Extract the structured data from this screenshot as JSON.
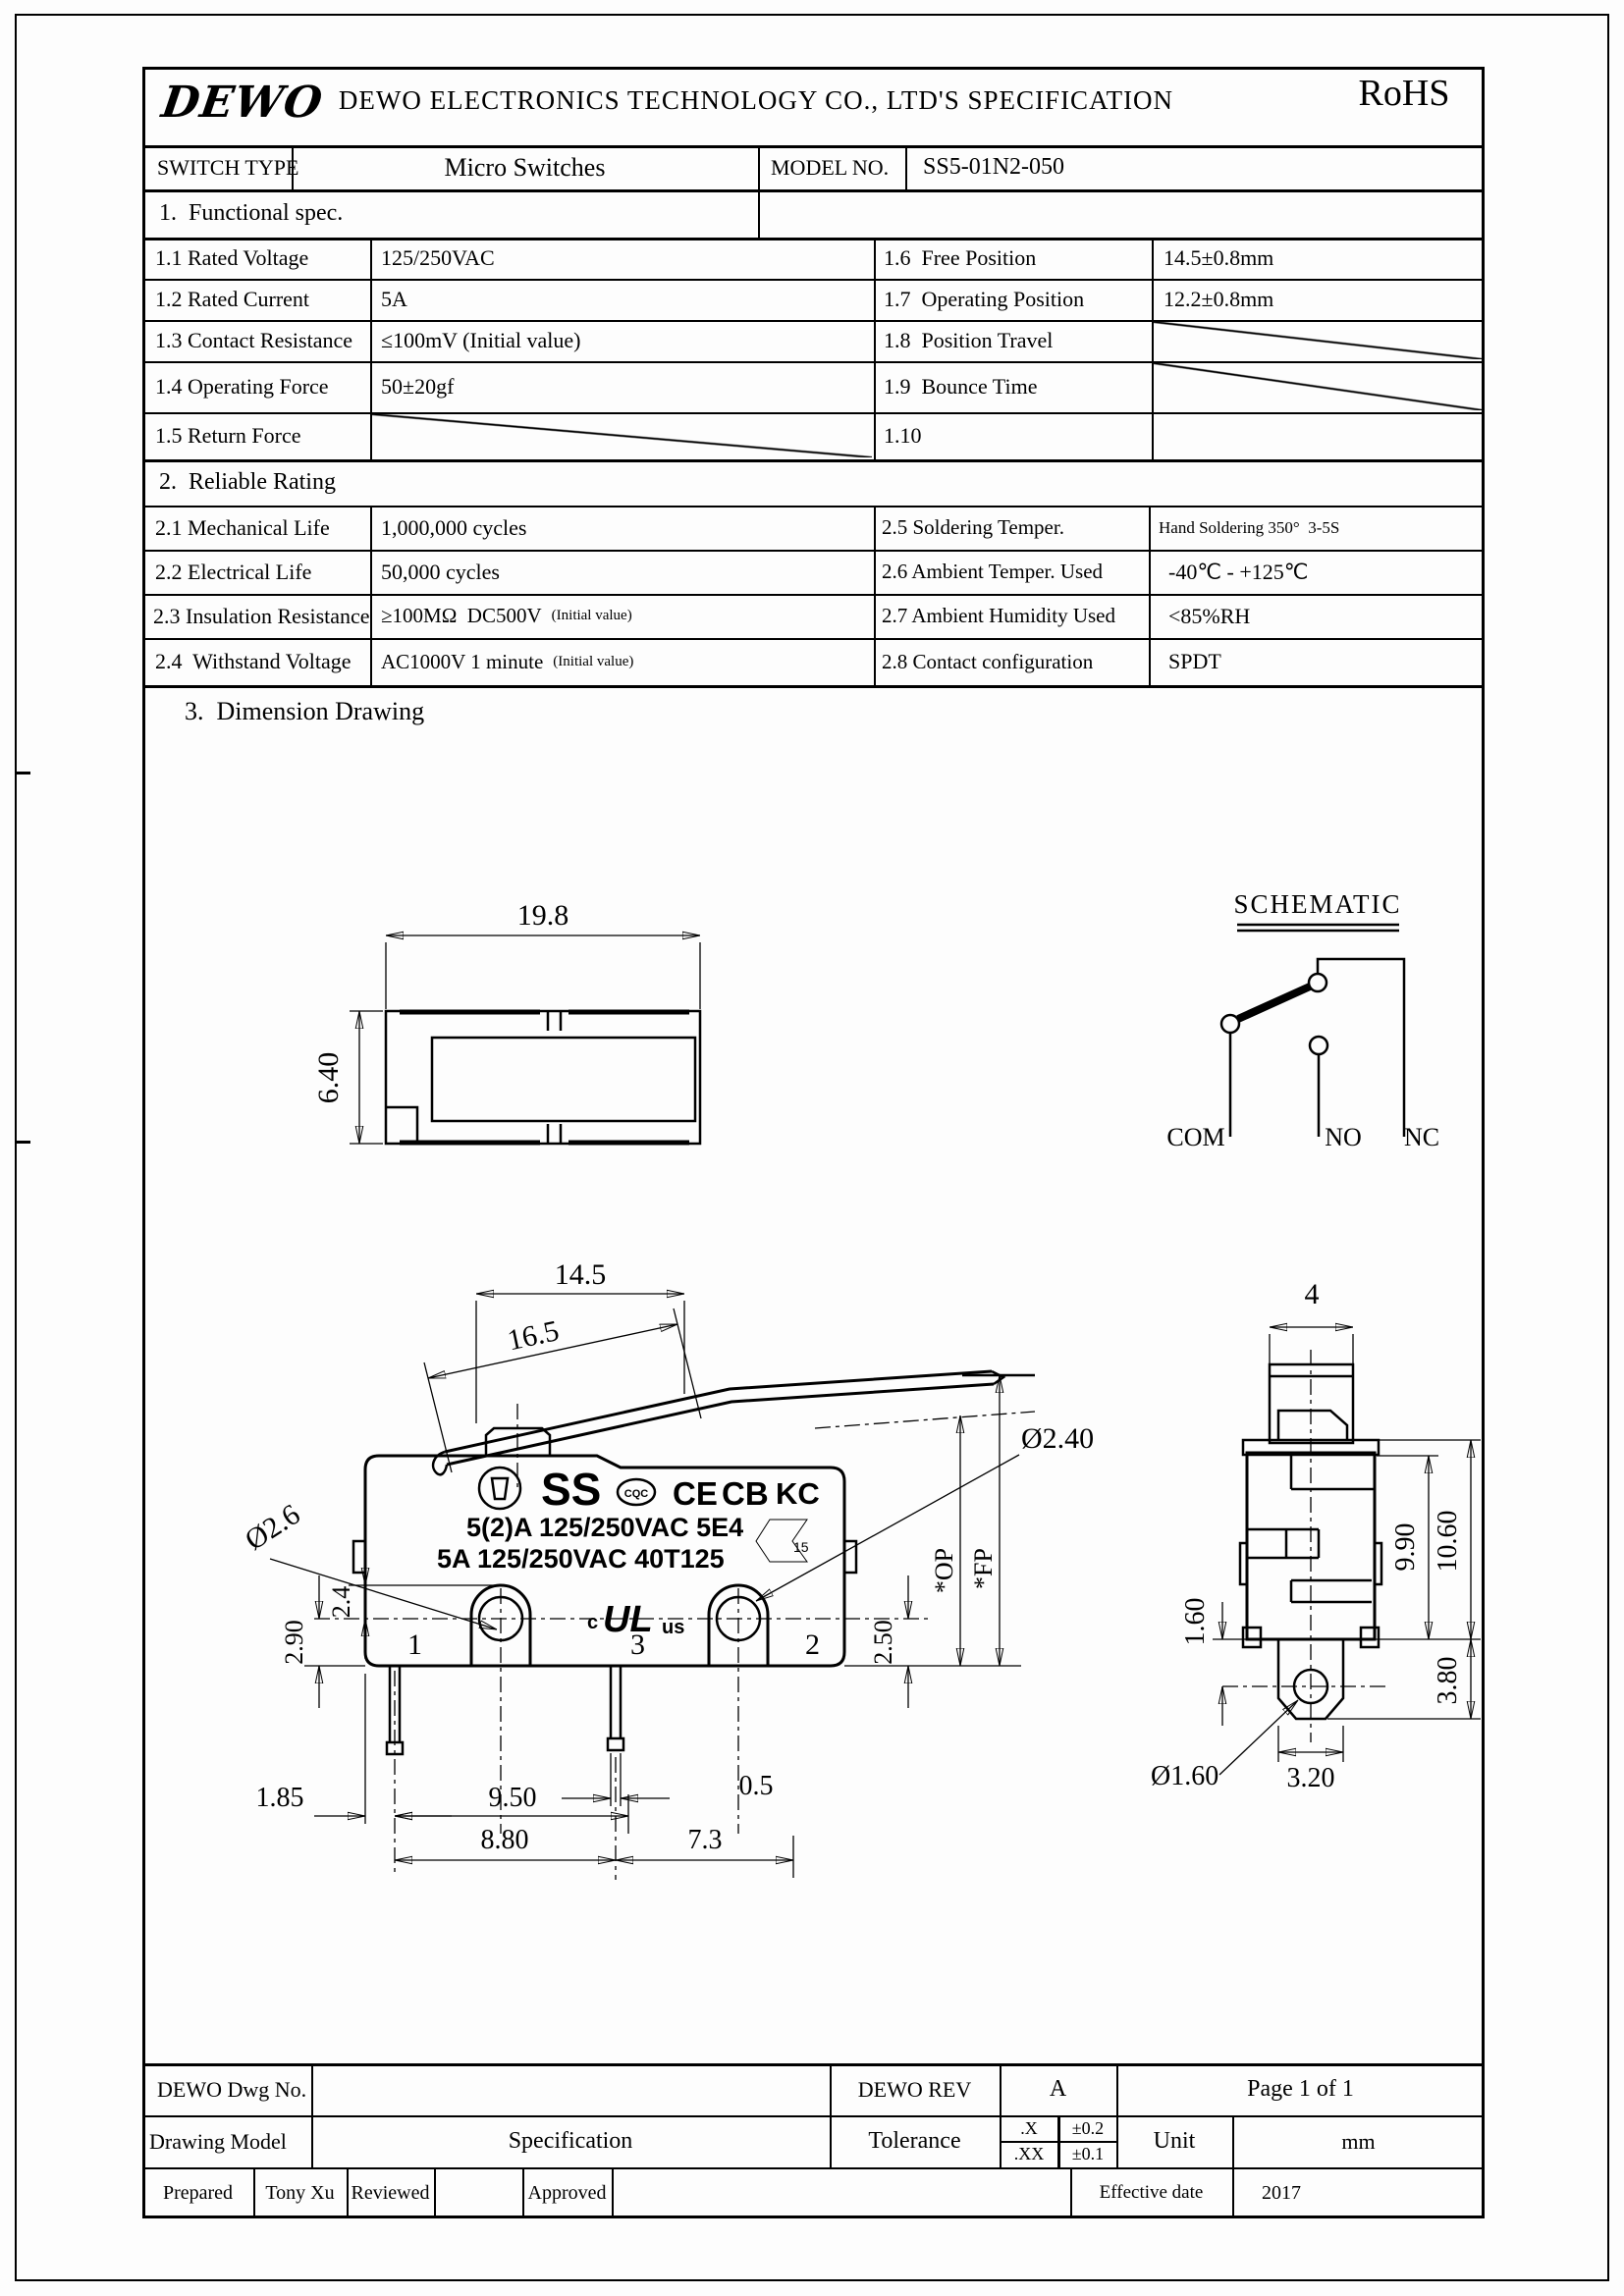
{
  "header": {
    "logo": "DEWO",
    "title": "DEWO ELECTRONICS TECHNOLOGY CO., LTD'S SPECIFICATION",
    "rohs": "RoHS"
  },
  "model_row": {
    "switch_type_label": "SWITCH TYPE",
    "switch_type_value": "Micro Switches",
    "model_label": "MODEL NO.",
    "model_value": "SS5-01N2-050"
  },
  "section1": {
    "title": "1.  Functional spec.",
    "rows": [
      {
        "label": "1.1 Rated Voltage",
        "value": "125/250VAC",
        "rlabel": "1.6  Free Position",
        "rvalue": "14.5±0.8mm"
      },
      {
        "label": "1.2 Rated Current",
        "value": "5A",
        "rlabel": "1.7  Operating Position",
        "rvalue": "12.2±0.8mm"
      },
      {
        "label": "1.3 Contact Resistance",
        "value": "≤100mV (Initial value)",
        "rlabel": "1.8  Position Travel",
        "rvalue": ""
      },
      {
        "label": "1.4 Operating Force",
        "value": "50±20gf",
        "rlabel": "1.9  Bounce Time",
        "rvalue": ""
      },
      {
        "label": "1.5 Return Force",
        "value": "",
        "rlabel": "1.10",
        "rvalue": ""
      }
    ]
  },
  "section2": {
    "title": "2.  Reliable Rating",
    "rows": [
      {
        "label": "2.1 Mechanical Life",
        "value": "1,000,000 cycles",
        "note": "",
        "rlabel": "2.5 Soldering Temper.",
        "rvalue": "Hand Soldering 350°  3-5S"
      },
      {
        "label": "2.2 Electrical Life",
        "value": "50,000 cycles",
        "note": "",
        "rlabel": "2.6 Ambient Temper. Used",
        "rvalue": "-40℃ - +125℃"
      },
      {
        "label": "2.3 Insulation Resistance",
        "value": "≥100MΩ  DC500V",
        "note": "(Initial value)",
        "rlabel": "2.7 Ambient Humidity Used",
        "rvalue": "<85%RH"
      },
      {
        "label": "2.4  Withstand Voltage",
        "value": "AC1000V 1 minute",
        "note": "(Initial value)",
        "rlabel": "2.8 Contact configuration",
        "rvalue": "SPDT"
      }
    ]
  },
  "drawing": {
    "title": "3.  Dimension Drawing",
    "top_view": {
      "dim_width": "19.8",
      "dim_height": "6.40"
    },
    "schematic": {
      "title": "SCHEMATIC",
      "com": "COM",
      "no_label": "NO",
      "nc": "NC"
    },
    "front_view": {
      "dim_a": "14.5",
      "dim_b": "16.5",
      "dia_left": "Ø2.6",
      "dia_right": "Ø2.40",
      "dim_c": "2.4",
      "dim_d": "2.90",
      "dim_e": "2.50",
      "dim_f": "1.85",
      "dim_g": "9.50",
      "dim_h": "0.5",
      "dim_i": "8.80",
      "dim_j": "7.3",
      "op": "*OP",
      "fp": "*FP",
      "t1": "1",
      "t2": "3",
      "t3": "2",
      "mark_ss": "SS",
      "mark_cqc": "CQC",
      "mark_ce": "CE",
      "mark_cb": "CB",
      "mark_kc": "KC",
      "mark_line1": "5(2)A 125/250VAC 5E4",
      "mark_line2": "5A 125/250VAC 40T125",
      "mark_15": "15",
      "mark_c": "c",
      "mark_ul": "UL",
      "mark_us": "us"
    },
    "side_view": {
      "dim_w": "4",
      "dim_h1": "9.90",
      "dim_h2": "10.60",
      "dim_h3": "3.80",
      "dim_k": "1.60",
      "dia": "Ø1.60",
      "dim_m": "3.20"
    }
  },
  "footer": {
    "dwg_no_label": "DEWO Dwg No.",
    "rev_label": "DEWO REV",
    "rev_value": "A",
    "page": "Page 1 of 1",
    "drawing_model_label": "Drawing Model",
    "drawing_model_value": "Specification",
    "tolerance_label": "Tolerance",
    "tol_x_label": ".X",
    "tol_x_value": "±0.2",
    "tol_xx_label": ".XX",
    "tol_xx_value": "±0.1",
    "unit_label": "Unit",
    "unit_value": "mm",
    "prepared_label": "Prepared",
    "prepared_value": "Tony Xu",
    "reviewed_label": "Reviewed",
    "approved_label": "Approved",
    "effective_label": "Effective date",
    "effective_value": "2017"
  }
}
